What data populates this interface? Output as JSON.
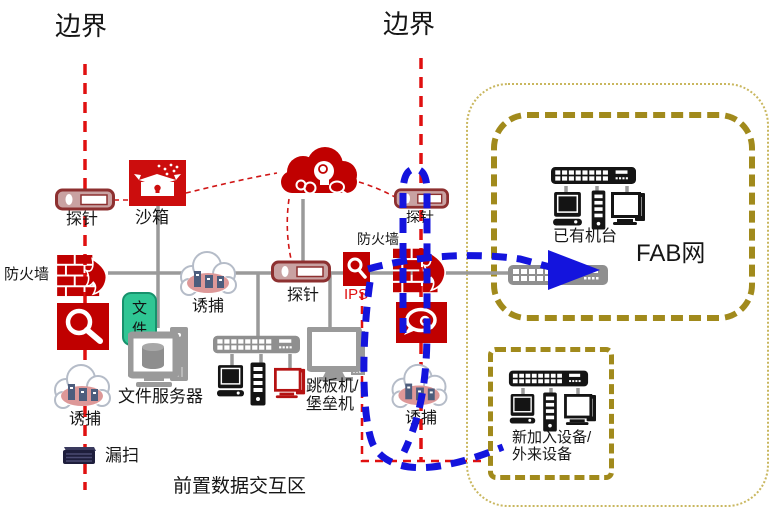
{
  "palette": {
    "icon_red": "#c00000",
    "probe_border_red": "#8d3030",
    "boundary_dash_red": "#e01010",
    "flow_blue": "#1414dd",
    "zone_olive": "#a18a1c",
    "zone_olive_light": "#c9b75f",
    "line_gray": "#9a9a9a",
    "device_black": "#141414",
    "file_tag_green": "#2fc694",
    "scan_server_navy": "#1e1e3c",
    "decoy_pink": "#dd9898"
  },
  "icons": {
    "probe": "network-tap-device",
    "sandbox": "box-with-lock",
    "threat_cloud": "ai-head-with-gears-cloud",
    "firewall": "brick-wall-flame",
    "scanner": "magnifier-box",
    "ips": "magnifier-box-small",
    "audit": "speech-bubble-magnifier-box",
    "decoy": "honeypot-city-cloud",
    "vuln_scan": "rack-server",
    "file_server": "monitor-with-database",
    "jump_host": "gray-workstation",
    "switch": "port-switch",
    "desktop": "desktop-pc",
    "tower": "server-tower",
    "monitor": "monitor-pc",
    "flow_arrow": "blue-dashed-arrow"
  },
  "labels": {
    "boundary_left": "边界",
    "boundary_right": "边界",
    "probe_left": "探针",
    "probe_mid": "探针",
    "probe_right": "探针",
    "sandbox": "沙箱",
    "firewall_left": "防火墙",
    "firewall_right": "防火墙",
    "decoy_top": "诱捕",
    "decoy_left": "诱捕",
    "decoy_right": "诱捕",
    "ips": "IPS",
    "file_tag": "文件",
    "file_server": "文件服务器",
    "jump_line1": "跳板机/",
    "jump_line2": "堡垒机",
    "vuln_scan": "漏扫",
    "existing_machines": "已有机台",
    "fab_network": "FAB网",
    "new_devices_line1": "新加入设备/",
    "new_devices_line2": "外来设备",
    "front_zone": "前置数据交互区"
  }
}
